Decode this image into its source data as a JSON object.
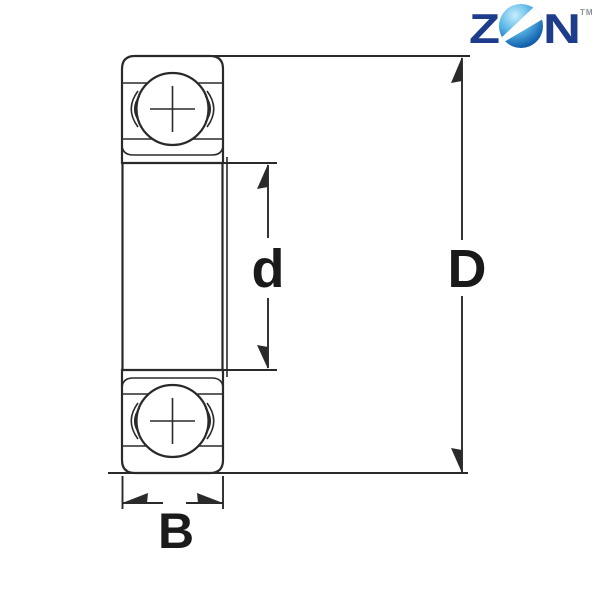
{
  "page": {
    "background": "#ffffff"
  },
  "logo": {
    "letter_z": "Z",
    "letter_n": "N",
    "trademark": "TM",
    "letter_color": "#1e3c8c",
    "trademark_color": "#8f9093",
    "sphere_colors": {
      "highlight": "#c7eefb",
      "light": "#5cb8e8",
      "deep": "#1565b0",
      "dark": "#0d2f6e"
    },
    "swoosh_color": "#ffffff"
  },
  "diagram": {
    "type": "deep-groove-ball-bearing-cross-section",
    "line_color": "#2a2a2a",
    "label_color": "#1a1a1a",
    "labels": {
      "bore_diameter": "d",
      "outer_diameter": "D",
      "width": "B"
    }
  }
}
